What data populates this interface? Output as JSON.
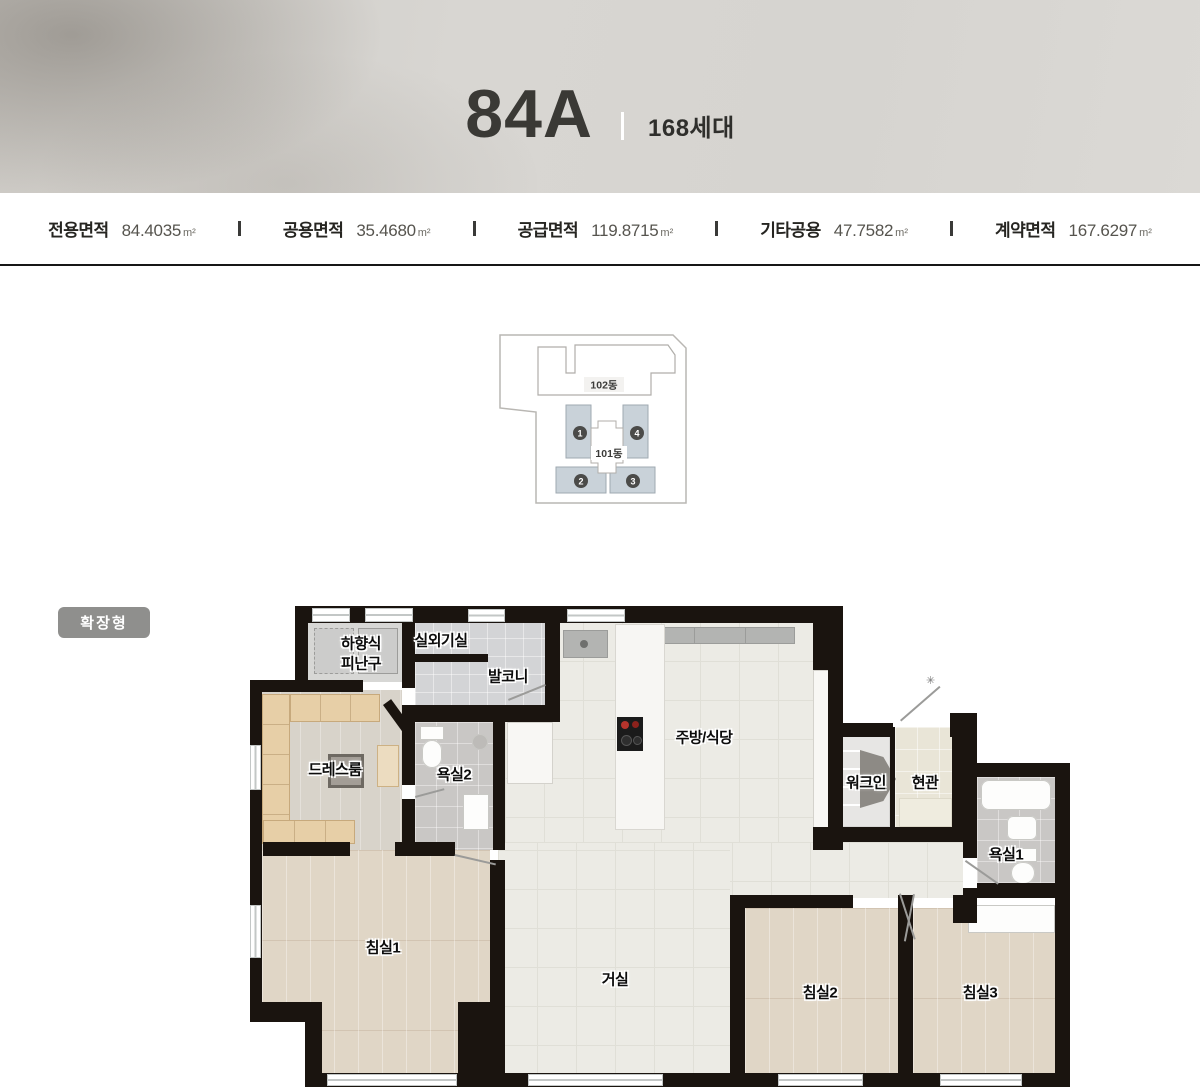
{
  "header": {
    "title": "84A",
    "unit_count": "168세대"
  },
  "area_bar": {
    "divider": "|",
    "items": [
      {
        "label": "전용면적",
        "value": "84.4035",
        "unit": "m²"
      },
      {
        "label": "공용면적",
        "value": "35.4680",
        "unit": "m²"
      },
      {
        "label": "공급면적",
        "value": "119.8715",
        "unit": "m²"
      },
      {
        "label": "기타공용",
        "value": "47.7582",
        "unit": "m²"
      },
      {
        "label": "계약면적",
        "value": "167.6297",
        "unit": "m²"
      }
    ]
  },
  "site_plan": {
    "building_back": "102동",
    "building_front": "101동",
    "unit_numbers": [
      "1",
      "2",
      "3",
      "4"
    ]
  },
  "badge": {
    "label": "확장형"
  },
  "floor_plan": {
    "entrance_marker": "✳",
    "rooms": {
      "escape_line1": "하향식",
      "escape_line2": "피난구",
      "outdoor_unit": "실외기실",
      "balcony": "발코니",
      "dress_room": "드레스룸",
      "bathroom2": "욕실2",
      "kitchen": "주방/식당",
      "walk_in": "워크인",
      "entrance": "현관",
      "bathroom1": "욕실1",
      "bedroom1": "침실1",
      "living": "거실",
      "bedroom2": "침실2",
      "bedroom3": "침실3"
    }
  }
}
